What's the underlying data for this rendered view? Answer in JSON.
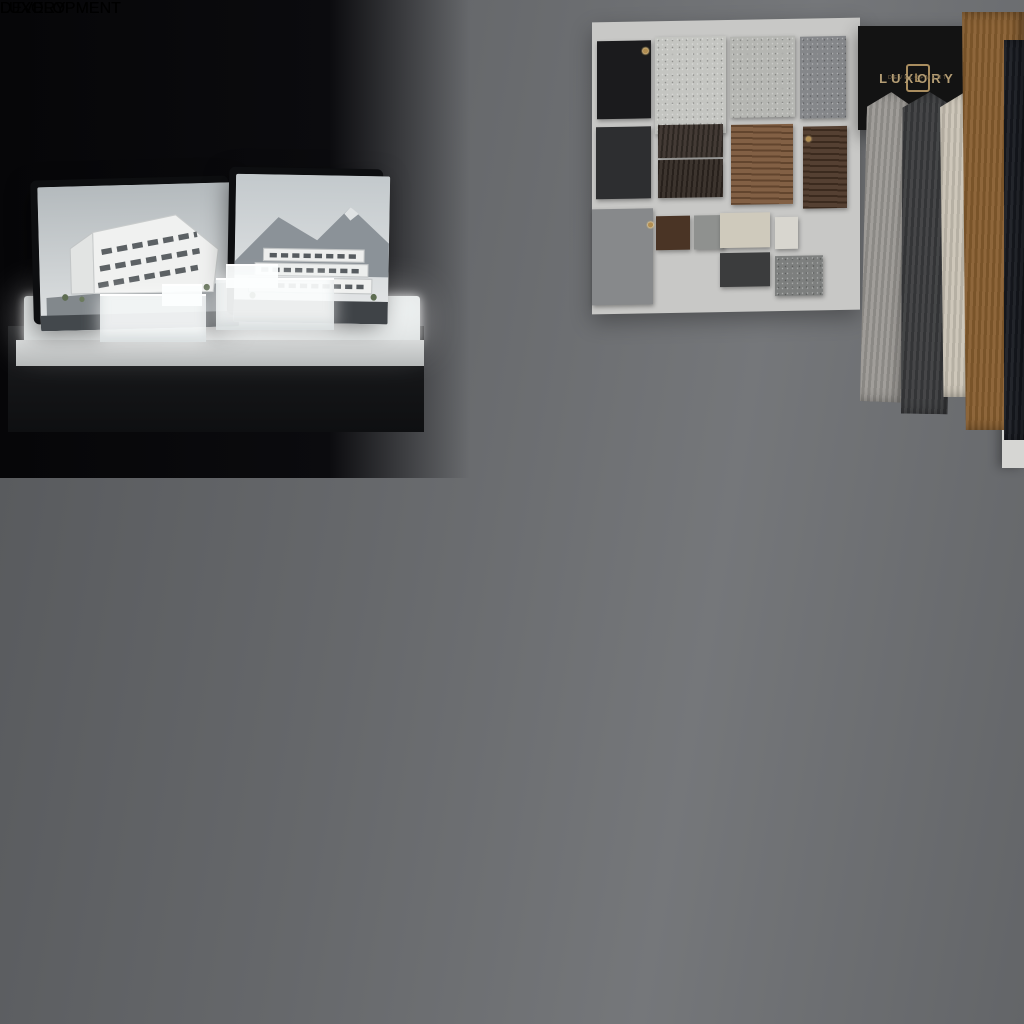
{
  "sign": {
    "brand": "LUXORY",
    "subtitle": "DEVELOPMENT",
    "monogram": "L",
    "background": "#131313",
    "text_color": "#b49d74"
  },
  "notebook": {
    "brand": "LUXORY",
    "subtitle": "DEVELOPMENT",
    "monogram": "L",
    "cover_color": "#6d4128",
    "emboss_color": "#8a5126"
  },
  "desk_board": {
    "label_brand": "LUXORY",
    "label_subtitle": "DEVELOPMENT",
    "grid": [
      [
        "#a7a5a0",
        "#6b5645",
        "#35322b",
        "#c1a47e",
        "#6e4c34"
      ],
      [
        "#56524a",
        "#262420",
        "#d6d0c2",
        "#5a3e2c",
        "#3e2c21"
      ],
      [
        "#ccc7ba",
        "#d8d3c5",
        "#6b4a33",
        "#372a20",
        "#2a2018"
      ]
    ],
    "strips": [
      "#c7c2b2",
      "#5e4936",
      "#8f8f8b",
      "#55554f",
      "#31312d",
      "#1e1e1c"
    ]
  },
  "wall_board": {
    "background": "#c8c8c6",
    "tiles": [
      {
        "name": "black-laminate",
        "color": "#1b1b1d"
      },
      {
        "name": "white-marble",
        "color": "#c4c5c1"
      },
      {
        "name": "concrete",
        "color": "#b5b6b2"
      },
      {
        "name": "granite",
        "color": "#85878a"
      },
      {
        "name": "slate",
        "color": "#2d2e30"
      },
      {
        "name": "smoked-oak",
        "color": "#39302a"
      },
      {
        "name": "espresso-oak",
        "color": "#322923"
      },
      {
        "name": "walnut",
        "color": "#7a5639"
      },
      {
        "name": "dark-walnut",
        "color": "#4a3425"
      },
      {
        "name": "ash-gray",
        "color": "#87898b"
      },
      {
        "name": "cocoa",
        "color": "#4a3425"
      },
      {
        "name": "pewter-small",
        "color": "#8f918f"
      },
      {
        "name": "sand",
        "color": "#cfcabc"
      },
      {
        "name": "ivory",
        "color": "#d8d6cf"
      },
      {
        "name": "charcoal",
        "color": "#3b3c3d"
      },
      {
        "name": "stone-gray",
        "color": "#7d7f7e"
      }
    ]
  },
  "fabrics": [
    {
      "name": "light-gray-wool",
      "color": "#9b9894"
    },
    {
      "name": "charcoal-wool",
      "color": "#3a3b3d"
    },
    {
      "name": "cream-linen",
      "color": "#cbc4b6"
    },
    {
      "name": "camel-suede",
      "color": "#875d2f"
    },
    {
      "name": "midnight-twill",
      "color": "#171a20"
    }
  ],
  "palette": {
    "wall_left": "#0a0a0c",
    "wall_right": "#696b6e",
    "wood_table": "#8a6847",
    "desk": "#c7c6c2",
    "platform_glow": "#f2f4f4",
    "blueprint_paper": "#eef0f1",
    "villa_window_glow": "#e9c78e",
    "tree_green": "#55713f"
  },
  "models": {
    "platform_concept_models": 2,
    "acrylic_model_trees": 2,
    "monitor_count": 2
  }
}
